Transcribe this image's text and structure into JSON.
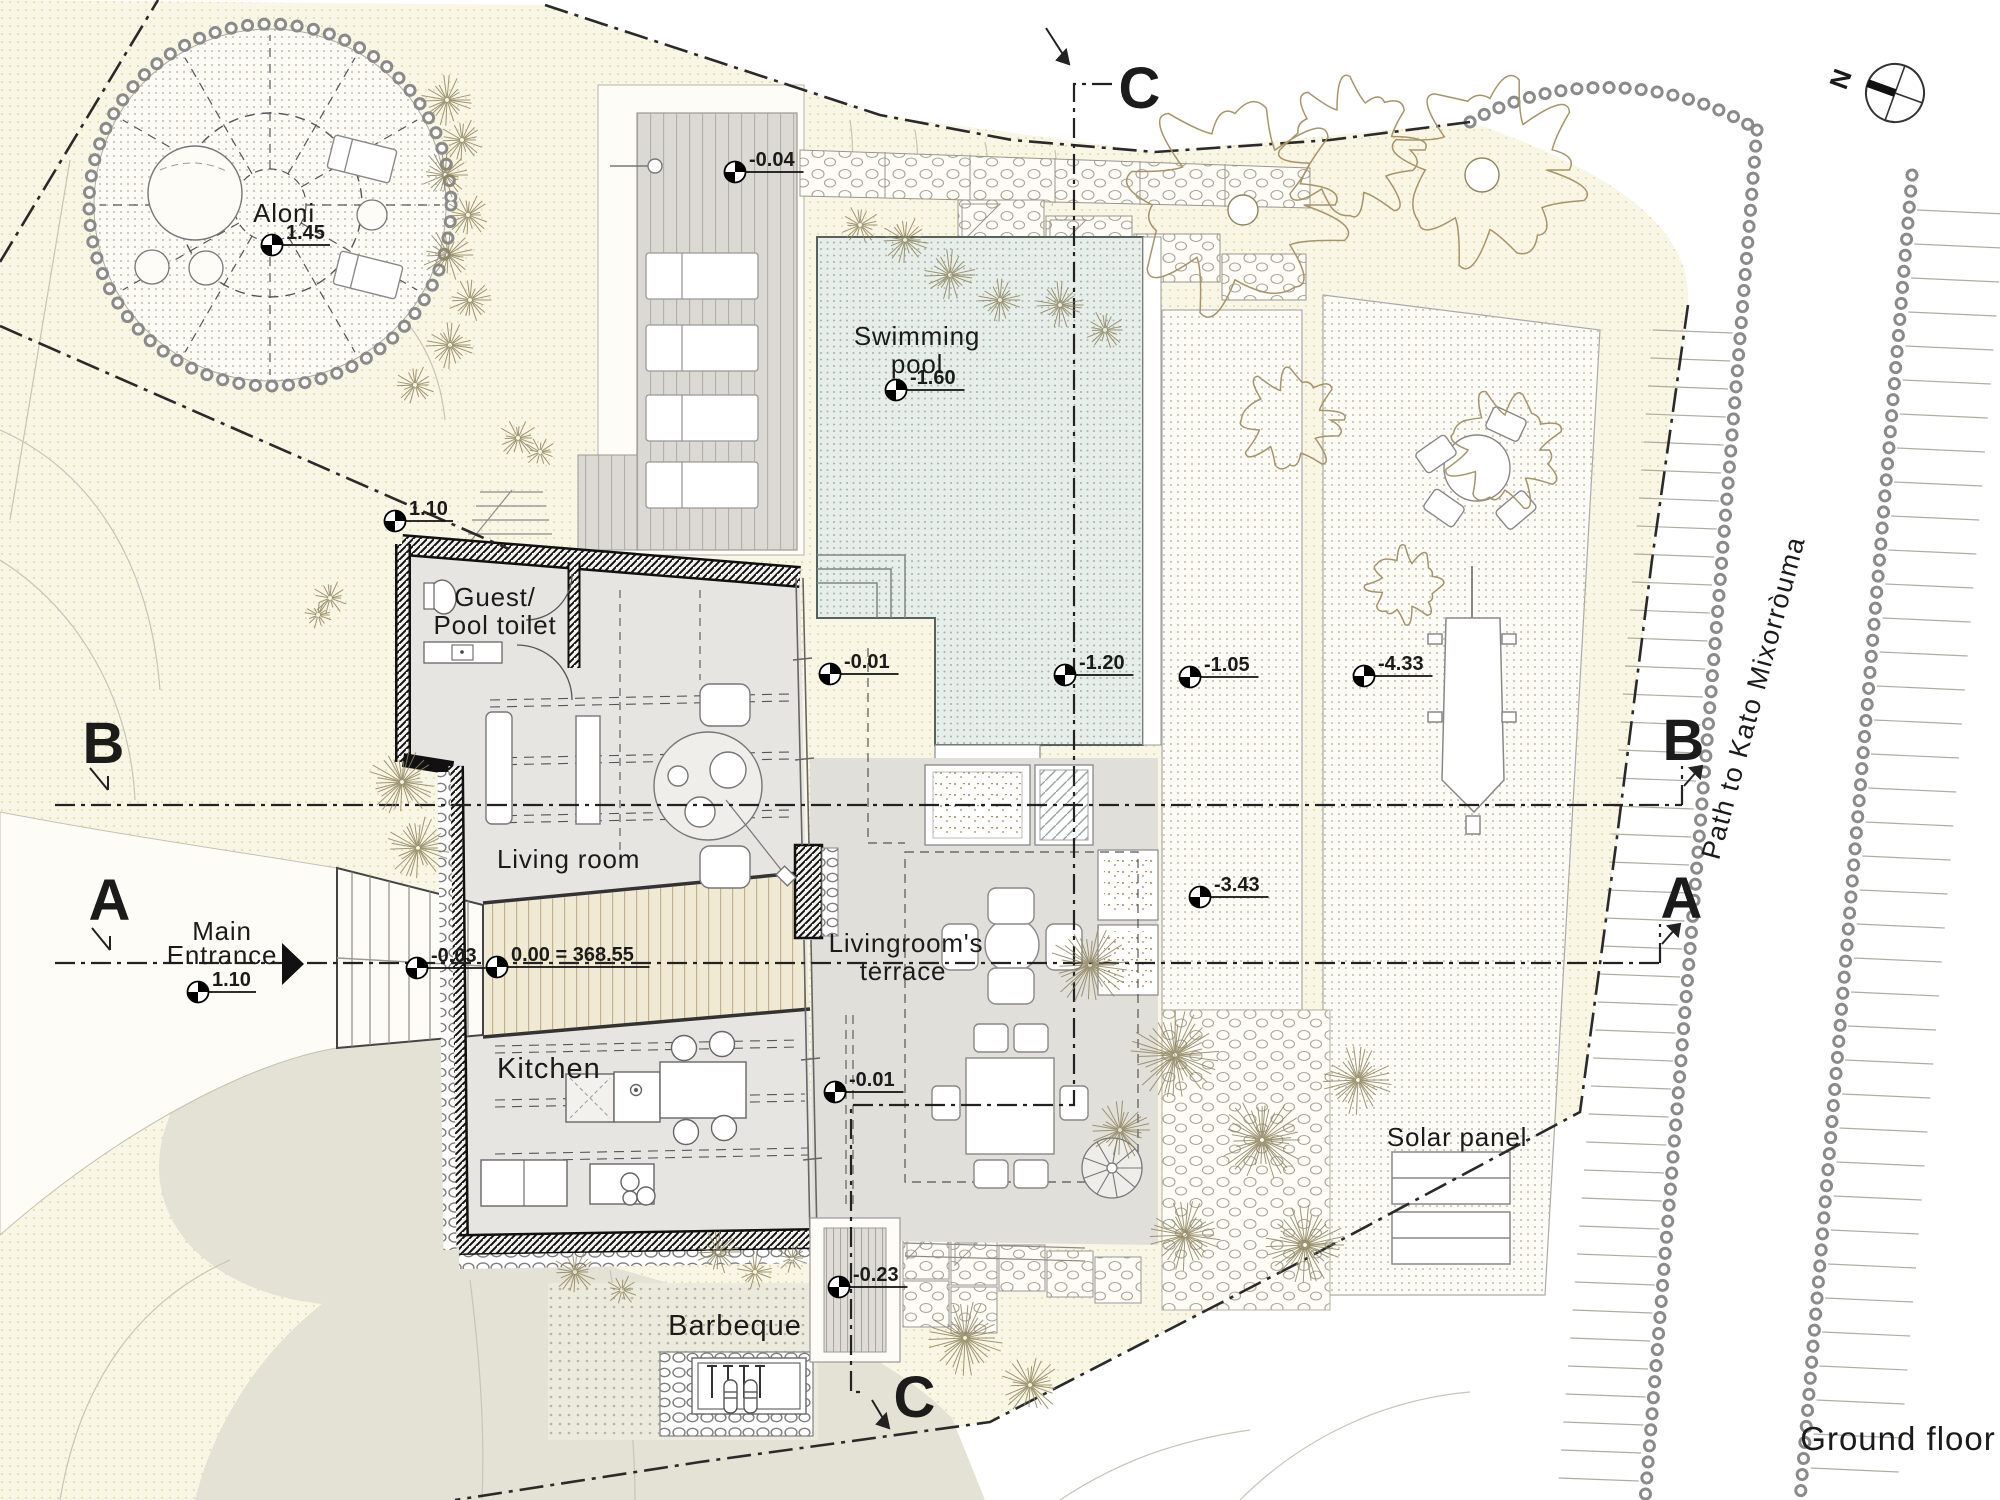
{
  "drawing": {
    "title": "Ground floor",
    "north_label": "N",
    "path_label": "Path to Kato Mixorròuma"
  },
  "rooms": {
    "aloni": "Aloni",
    "swimming_pool": [
      "Swimming",
      "pool"
    ],
    "guest_toilet": [
      "Guest/",
      "Pool toilet"
    ],
    "living_room": "Living room",
    "main_entrance": [
      "Main",
      "Entrance"
    ],
    "kitchen": "Kitchen",
    "living_terrace": [
      "Livingroom's",
      "terrace"
    ],
    "barbeque": "Barbeque",
    "solar_panel": "Solar panel"
  },
  "sections": {
    "a": "A",
    "b": "B",
    "c": "C"
  },
  "elevation_markers": [
    {
      "value": "1.45",
      "x": 272,
      "y": 245
    },
    {
      "value": "-0.04",
      "x": 735,
      "y": 172
    },
    {
      "value": "-1.60",
      "x": 896,
      "y": 390
    },
    {
      "value": "1.10",
      "x": 395,
      "y": 521
    },
    {
      "value": "1.10",
      "x": 198,
      "y": 992
    },
    {
      "value": "-0.03",
      "x": 417,
      "y": 968
    },
    {
      "value": "0.00 = 368.55",
      "x": 497,
      "y": 967
    },
    {
      "value": "-0.01",
      "x": 830,
      "y": 674
    },
    {
      "value": "-0.01",
      "x": 835,
      "y": 1092
    },
    {
      "value": "-1.20",
      "x": 1065,
      "y": 675
    },
    {
      "value": "-1.05",
      "x": 1190,
      "y": 677
    },
    {
      "value": "-4.33",
      "x": 1364,
      "y": 676
    },
    {
      "value": "-3.43",
      "x": 1200,
      "y": 897
    },
    {
      "value": "-0.23",
      "x": 839,
      "y": 1287
    }
  ],
  "colors": {
    "paper": "#ffffff",
    "site_cream": "#f9f6e6",
    "pool_water": "#e7eee9",
    "floor_gray": "#e6e5e1",
    "terrace_gray": "#e0dfda",
    "deck_gray": "#dbd9d3",
    "ramp_wood": "#f0e9d3",
    "blob_sage": "#e4e2d4",
    "line_dark": "#1b1b1b"
  }
}
